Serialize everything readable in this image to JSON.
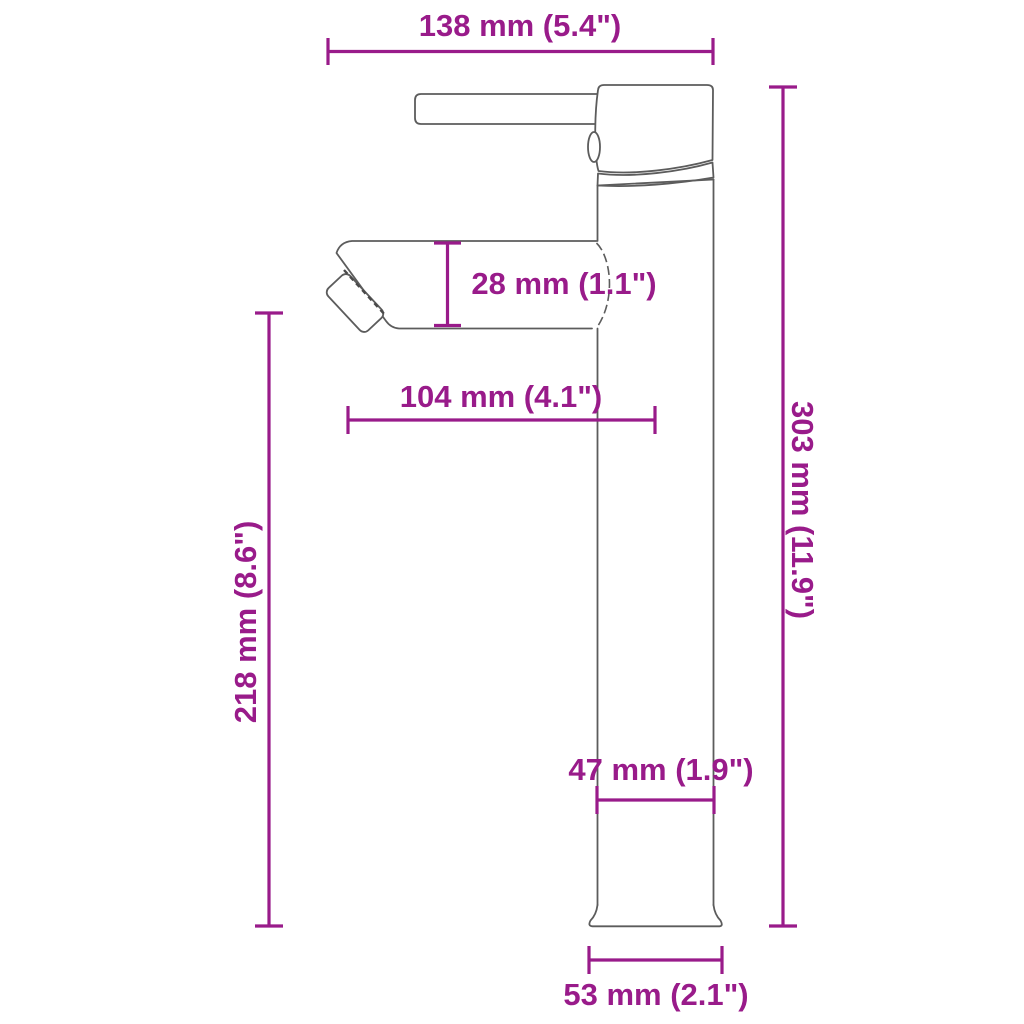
{
  "diagram_type": "product-dimension-drawing",
  "subject": "tall single-lever basin faucet, side view",
  "colors": {
    "dimension": "#991b8a",
    "outline": "#5c5c5c",
    "background": "#ffffff"
  },
  "dimensions": {
    "top_width": "138 mm (5.4\")",
    "spout_depth": "28 mm (1.1\")",
    "spout_reach": "104 mm (4.1\")",
    "spout_clearance": "218 mm (8.6\")",
    "total_height": "303 mm (11.9\")",
    "body_width": "47 mm (1.9\")",
    "base_width": "53 mm (2.1\")"
  }
}
